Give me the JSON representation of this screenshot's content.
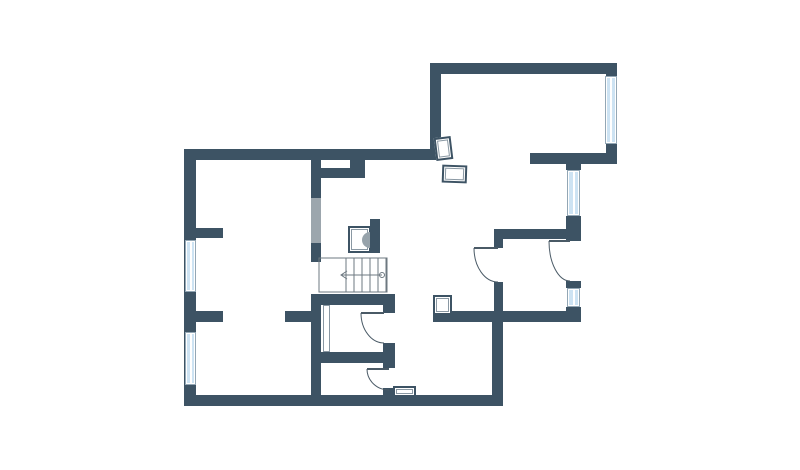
{
  "canvas": {
    "width": 800,
    "height": 470,
    "background": "#ffffff"
  },
  "colors": {
    "wall": "#3d5364",
    "window_fill": "#cde3f3",
    "window_frame": "#ffffff",
    "window_edge": "#93a7b5",
    "pocket_door": "#9ca6ad",
    "stair_line": "#6d7880",
    "door_line": "#4a5a66",
    "fixture_border": "#3d5364",
    "fixture_inner": "#8a98a3",
    "boiler_fill": "#97a3ab"
  },
  "plan": {
    "walls": [
      {
        "name": "outer-wall-left",
        "x": 184,
        "y": 149,
        "w": 12,
        "h": 257
      },
      {
        "name": "outer-wall-top-main",
        "x": 184,
        "y": 149,
        "w": 257,
        "h": 11
      },
      {
        "name": "outer-wall-upper-connector",
        "x": 430,
        "y": 63,
        "w": 11,
        "h": 97
      },
      {
        "name": "outer-wall-top-right",
        "x": 430,
        "y": 63,
        "w": 187,
        "h": 11
      },
      {
        "name": "outer-wall-right-above-window",
        "x": 606,
        "y": 63,
        "w": 11,
        "h": 13
      },
      {
        "name": "outer-wall-right-below-window",
        "x": 606,
        "y": 144,
        "w": 11,
        "h": 20
      },
      {
        "name": "wall-step-right",
        "x": 530,
        "y": 153,
        "w": 87,
        "h": 11
      },
      {
        "name": "right-column-stub-top",
        "x": 566,
        "y": 164,
        "w": 15,
        "h": 6
      },
      {
        "name": "right-column-mid-block",
        "x": 566,
        "y": 216,
        "w": 15,
        "h": 25
      },
      {
        "name": "right-column-sill",
        "x": 566,
        "y": 281,
        "w": 15,
        "h": 7
      },
      {
        "name": "right-column-bottom-block",
        "x": 566,
        "y": 307,
        "w": 15,
        "h": 15
      },
      {
        "name": "wall-bottom-right",
        "x": 433,
        "y": 311,
        "w": 148,
        "h": 11
      },
      {
        "name": "wall-right-connector-down",
        "x": 492,
        "y": 322,
        "w": 11,
        "h": 79
      },
      {
        "name": "outer-wall-bottom",
        "x": 184,
        "y": 395,
        "w": 319,
        "h": 11
      },
      {
        "name": "corridor-wall-upper",
        "x": 311,
        "y": 160,
        "w": 10,
        "h": 38
      },
      {
        "name": "corridor-wall-mid",
        "x": 311,
        "y": 243,
        "w": 10,
        "h": 19
      },
      {
        "name": "corridor-wall-lower",
        "x": 311,
        "y": 294,
        "w": 10,
        "h": 101
      },
      {
        "name": "hall-stub-wall",
        "x": 311,
        "y": 168,
        "w": 54,
        "h": 10
      },
      {
        "name": "hall-stub-block",
        "x": 350,
        "y": 149,
        "w": 15,
        "h": 29
      },
      {
        "name": "left-room-divider-stub",
        "x": 196,
        "y": 228,
        "w": 27,
        "h": 10
      },
      {
        "name": "left-lower-stub-west",
        "x": 196,
        "y": 311,
        "w": 27,
        "h": 11
      },
      {
        "name": "left-lower-stub-east",
        "x": 285,
        "y": 311,
        "w": 26,
        "h": 11
      },
      {
        "name": "bathroom-north-wall",
        "x": 321,
        "y": 294,
        "w": 74,
        "h": 11
      },
      {
        "name": "bathroom-east-wall-upper",
        "x": 383,
        "y": 294,
        "w": 12,
        "h": 19
      },
      {
        "name": "bathroom-east-wall-mid",
        "x": 383,
        "y": 343,
        "w": 12,
        "h": 25
      },
      {
        "name": "bathroom-south-wall",
        "x": 321,
        "y": 352,
        "w": 62,
        "h": 11
      },
      {
        "name": "door-lobby-jamb-block",
        "x": 383,
        "y": 388,
        "w": 12,
        "h": 8
      },
      {
        "name": "hall-south-wall",
        "x": 494,
        "y": 229,
        "w": 73,
        "h": 10
      },
      {
        "name": "door-hall-north-jamb",
        "x": 494,
        "y": 239,
        "w": 9,
        "h": 9
      },
      {
        "name": "door-hall-south-stub",
        "x": 494,
        "y": 282,
        "w": 9,
        "h": 29
      },
      {
        "name": "stair-side-wall",
        "x": 370,
        "y": 219,
        "w": 10,
        "h": 34
      }
    ],
    "pocket_doors": [
      {
        "name": "pocket-door-corridor",
        "x": 311,
        "y": 198,
        "w": 10,
        "h": 45
      }
    ],
    "windows": [
      {
        "name": "window-left-upper",
        "x": 185,
        "y": 240,
        "w": 11,
        "h": 52
      },
      {
        "name": "window-left-lower",
        "x": 185,
        "y": 332,
        "w": 11,
        "h": 53
      },
      {
        "name": "window-right-top",
        "x": 605,
        "y": 76,
        "w": 12,
        "h": 68
      },
      {
        "name": "window-right-mid",
        "x": 567,
        "y": 170,
        "w": 13,
        "h": 46
      },
      {
        "name": "window-right-low",
        "x": 567,
        "y": 288,
        "w": 13,
        "h": 19
      }
    ],
    "doors": [
      {
        "name": "door-hall-west",
        "hinge": [
          498,
          248
        ],
        "tip": [
          474,
          248
        ],
        "jamb": [
          498,
          282
        ]
      },
      {
        "name": "door-hall-east",
        "hinge": [
          570,
          241
        ],
        "tip": [
          549,
          241
        ],
        "jamb": [
          570,
          281
        ]
      },
      {
        "name": "door-bathroom",
        "hinge": [
          384,
          313
        ],
        "tip": [
          361,
          313
        ],
        "jamb": [
          384,
          343
        ]
      },
      {
        "name": "door-lobby",
        "hinge": [
          389,
          369
        ],
        "tip": [
          367,
          369
        ],
        "jamb": [
          389,
          390
        ]
      }
    ],
    "stairs": {
      "box": {
        "x": 319,
        "y": 258,
        "w": 68,
        "h": 34
      },
      "treads_x": [
        346,
        354,
        362,
        370,
        378,
        386
      ],
      "walk_line": {
        "y": 275,
        "x1": 341,
        "x2": 382
      },
      "arrow_points": "347,271 341,275 347,279",
      "start_circle": {
        "cx": 382,
        "cy": 275,
        "r": 2.5
      }
    },
    "boiler_semicircle": {
      "cx": 370,
      "cy": 240,
      "r": 8
    },
    "fixtures": [
      {
        "name": "fixture-top-right-a",
        "x": 435,
        "y": 137,
        "w": 17,
        "h": 23,
        "rot": -7,
        "thin": false
      },
      {
        "name": "fixture-top-right-b",
        "x": 442,
        "y": 165,
        "w": 25,
        "h": 18,
        "rot": 2,
        "thin": false
      },
      {
        "name": "fixture-boiler",
        "x": 348,
        "y": 226,
        "w": 23,
        "h": 27,
        "rot": 0,
        "thin": false
      },
      {
        "name": "fixture-hall-sink",
        "x": 433,
        "y": 295,
        "w": 19,
        "h": 20,
        "rot": 0,
        "thin": false
      },
      {
        "name": "fixture-bottom-vent",
        "x": 393,
        "y": 386,
        "w": 23,
        "h": 11,
        "rot": 0,
        "thin": false
      },
      {
        "name": "fixture-duct",
        "x": 323,
        "y": 305,
        "w": 7,
        "h": 47,
        "rot": 0,
        "thin": true
      }
    ]
  }
}
